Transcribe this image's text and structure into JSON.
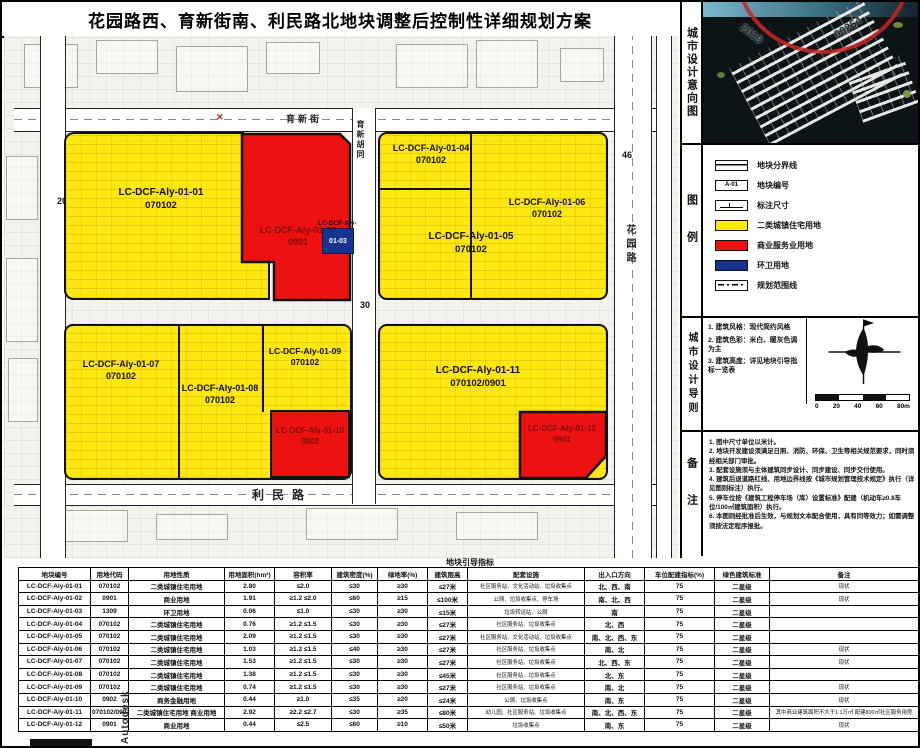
{
  "title": "花园路西、育新街南、利民路北地块调整后控制性详细规划方案",
  "colors": {
    "residential_yellow": "#FFE712",
    "commercial_red": "#EE1111",
    "sanitation_blue": "#16338E",
    "stamp_red": "#CD2323"
  },
  "map": {
    "roads": {
      "top": "育新街",
      "bottom": "利民路",
      "right": "花园路",
      "middle": "育新胡同"
    },
    "dims": {
      "left": "20",
      "middle": "30",
      "right": "46"
    },
    "parcels": [
      {
        "id": "LC-DCF-Aly-01-01",
        "code": "070102"
      },
      {
        "id": "LC-DCF-Aly-01-02",
        "code": "0901"
      },
      {
        "id": "LC-DCF-Aly-",
        "code": "01-03"
      },
      {
        "id": "LC-DCF-Aly-01-04",
        "code": "070102"
      },
      {
        "id": "LC-DCF-Aly-01-05",
        "code": "070102"
      },
      {
        "id": "LC-DCF-Aly-01-06",
        "code": "070102"
      },
      {
        "id": "LC-DCF-Aly-01-07",
        "code": "070102"
      },
      {
        "id": "LC-DCF-Aly-01-08",
        "code": "070102"
      },
      {
        "id": "LC-DCF-Aly-01-09",
        "code": "070102"
      },
      {
        "id": "LC-DCF-Aly-01-10",
        "code": "0902"
      },
      {
        "id": "LC-DCF-Aly-01-11",
        "code": "070102/0901"
      },
      {
        "id": "LC-DCF-Aly-01-12",
        "code": "0901"
      }
    ]
  },
  "sidebar": {
    "section1_label": "城市设计意向图",
    "section2_label": "图例",
    "section3_label": "城市设计导则",
    "section4_label": "备注",
    "stamp": {
      "left": "2019",
      "right": "00254"
    },
    "legend": [
      {
        "label": "地块分界线"
      },
      {
        "label": "地块编号",
        "sample": "A-01"
      },
      {
        "label": "标注尺寸"
      },
      {
        "label": "二类城镇住宅用地"
      },
      {
        "label": "商业服务业用地"
      },
      {
        "label": "环卫用地"
      },
      {
        "label": "规划范围线"
      }
    ],
    "guidelines": [
      "1. 建筑风格：现代简约风格",
      "2. 建筑色彩：米白、暖灰色调为主",
      "3. 建筑高度：详见地块引导指标一览表"
    ],
    "scale_labels": [
      "0",
      "20",
      "40",
      "60",
      "80m"
    ],
    "notes": [
      "1. 图中尺寸单位以米计。",
      "2. 地块开发建设须满足日照、消防、环保、卫生等相关规范要求，同时须经相关部门审批。",
      "3. 配套设施须与主体建筑同步设计、同步建设、同步交付使用。",
      "4. 建筑后退道路红线、用地边界线按《城市规划管理技术规定》执行（详见图则标注）执行。",
      "5. 停车位按《建筑工程停车场（库）设置标准》配建（机动车≥0.8车位/100㎡建筑面积）执行。",
      "6. 本图则经批准后生效，与规划文本配合使用，具有同等效力；如需调整须按法定程序报批。"
    ]
  },
  "table": {
    "title": "地块引导指标",
    "headers": [
      "地块编号",
      "用地代码",
      "用地性质",
      "用地面积(hm²)",
      "容积率",
      "建筑密度(%)",
      "绿地率(%)",
      "建筑限高",
      "配套设施",
      "出入口方向",
      "车位配建指标(%)",
      "绿色建筑标准",
      "备注"
    ],
    "rows": [
      [
        "LC-DCF-Aly-01-01",
        "070102",
        "二类城镇住宅用地",
        "2.80",
        "≤2.0",
        "≤30",
        "≥30",
        "≤27米",
        "社区服务站、文化活动站、垃圾收集点",
        "北、西、南",
        "75",
        "二星级",
        "现状"
      ],
      [
        "LC-DCF-Aly-01-02",
        "0901",
        "商业用地",
        "1.91",
        "≥1.2 ≤2.0",
        "≤60",
        "≥15",
        "≤100米",
        "公厕、垃圾收集点、停车场",
        "南、北、西",
        "75",
        "二星级",
        "现状"
      ],
      [
        "LC-DCF-Aly-01-03",
        "1309",
        "环卫用地",
        "0.06",
        "≤1.0",
        "≤30",
        "≥30",
        "≤15米",
        "垃圾转运站、公厕",
        "南",
        "75",
        "二星级",
        ""
      ],
      [
        "LC-DCF-Aly-01-04",
        "070102",
        "二类城镇住宅用地",
        "0.76",
        "≥1.2 ≤1.5",
        "≤30",
        "≥30",
        "≤27米",
        "社区服务站、垃圾收集点",
        "北、西",
        "75",
        "二星级",
        ""
      ],
      [
        "LC-DCF-Aly-01-05",
        "070102",
        "二类城镇住宅用地",
        "2.09",
        "≥1.2 ≤1.5",
        "≤30",
        "≥30",
        "≤27米",
        "社区服务站、文化活动站、垃圾收集点",
        "南、北、西、东",
        "75",
        "二星级",
        ""
      ],
      [
        "LC-DCF-Aly-01-06",
        "070102",
        "二类城镇住宅用地",
        "1.03",
        "≥1.2 ≤1.5",
        "≤40",
        "≥30",
        "≤27米",
        "社区服务站、垃圾收集点",
        "南、北",
        "75",
        "二星级",
        "现状"
      ],
      [
        "LC-DCF-Aly-01-07",
        "070102",
        "二类城镇住宅用地",
        "1.53",
        "≥1.2 ≤1.5",
        "≤30",
        "≥30",
        "≤27米",
        "社区服务站、垃圾收集点",
        "北、西、东",
        "75",
        "二星级",
        "现状"
      ],
      [
        "LC-DCF-Aly-01-08",
        "070102",
        "二类城镇住宅用地",
        "1.38",
        "≥1.2 ≤1.5",
        "≤30",
        "≥30",
        "≤45米",
        "社区服务站、垃圾收集点",
        "北、东",
        "75",
        "二星级",
        ""
      ],
      [
        "LC-DCF-Aly-01-09",
        "070102",
        "二类城镇住宅用地",
        "0.74",
        "≥1.2 ≤1.5",
        "≤30",
        "≥30",
        "≤27米",
        "社区服务站、垃圾收集点",
        "南、北",
        "75",
        "二星级",
        "现状"
      ],
      [
        "LC-DCF-Aly-01-10",
        "0902",
        "商务金融用地",
        "0.44",
        "≥1.0",
        "≤35",
        "≥20",
        "≤24米",
        "公厕、垃圾收集点",
        "南、东",
        "75",
        "二星级",
        "现状"
      ],
      [
        "LC-DCF-Aly-01-11",
        "070102/0901",
        "二类城镇住宅用地 商业用地",
        "2.92",
        "≥2.2 ≤2.7",
        "≤30",
        "≥35",
        "≤80米",
        "幼儿园、社区服务站、垃圾收集点",
        "南、北、西、东",
        "75",
        "二星级",
        "其中商业建筑面积不大于1.1万㎡ 配建800㎡社区服务用房"
      ],
      [
        "LC-DCF-Aly-01-12",
        "0901",
        "商业用地",
        "0.44",
        "≤2.5",
        "≤60",
        "≥10",
        "≤50米",
        "垃圾收集点",
        "南、东",
        "75",
        "二星级",
        "现状"
      ]
    ]
  },
  "watermark": "Autodesk"
}
